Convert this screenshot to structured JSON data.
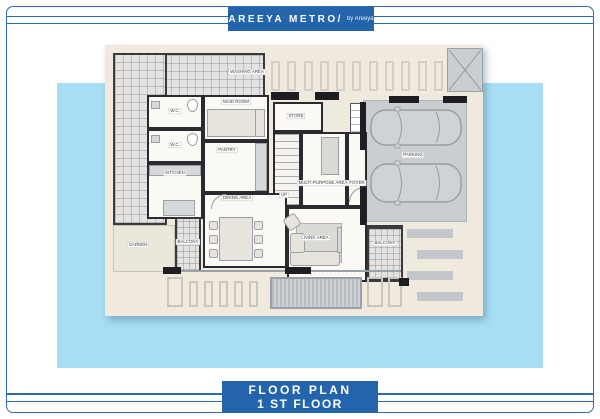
{
  "header": {
    "brand": "AREEYA METRO/",
    "byline": "by Areeya"
  },
  "footer": {
    "line1": "FLOOR  PLAN",
    "line2": "1 ST FLOOR"
  },
  "rooms": {
    "washing_area": "WASHING AREA",
    "maid_room": "MAID ROOM",
    "wc": "W.C.",
    "pantry": "PANTRY",
    "kitchen": "KITCHEN",
    "store": "STORE",
    "up": "UP",
    "multi_purpose": "MULTI-PURPOSE AREA",
    "foyer": "FOYER",
    "dining": "DINING AREA",
    "living": "LIVING AREA",
    "balcony": "BALCONY",
    "garden": "GARDEN",
    "parking": "PARKING"
  },
  "colors": {
    "brand_blue": "#2464AC",
    "sky_blue": "#A7DEF3",
    "plan_cream": "#EFE9DE",
    "wall_black": "#2A2A30",
    "parking_gray": "#C9CED3"
  }
}
